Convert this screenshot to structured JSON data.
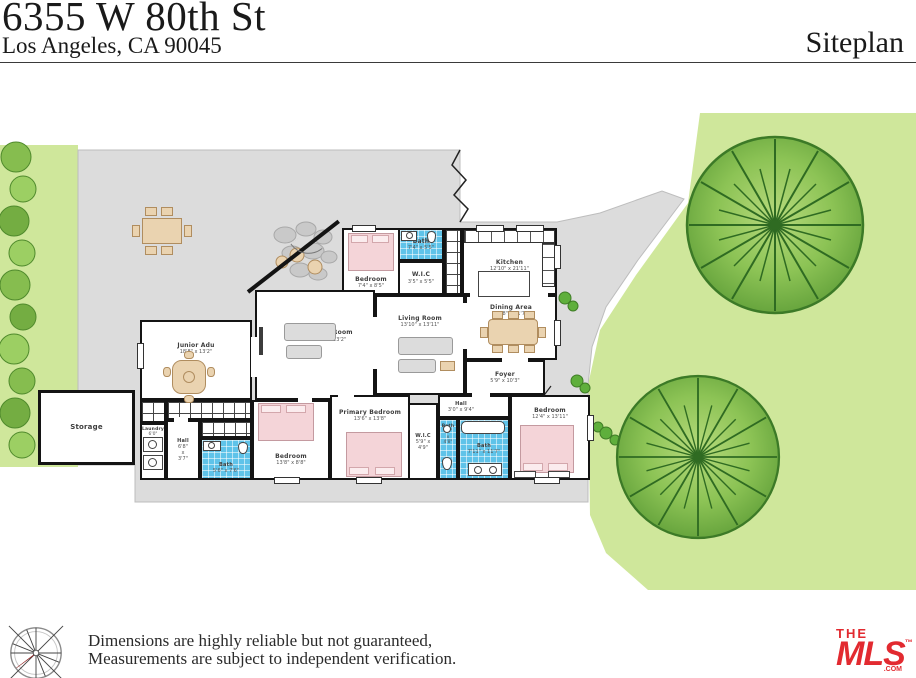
{
  "header": {
    "address_line1": "6355 W 80th St",
    "address_line2": "Los Angeles, CA 90045",
    "sheet_label": "Siteplan"
  },
  "rooms": {
    "bedroom_top": {
      "label": "Bedroom",
      "dims": "7'4\" x 8'5\""
    },
    "bath_top": {
      "label": "Bath",
      "dims": "7'4\" x 5'5\""
    },
    "wic_top": {
      "label": "W.I.C",
      "dims": "3'5\" x 5'5\""
    },
    "kitchen": {
      "label": "Kitchen",
      "dims": "12'10\" x 21'11\""
    },
    "living_room": {
      "label": "Living Room",
      "dims": "13'10\" x 13'11\""
    },
    "dining_area": {
      "label": "Dining Area",
      "dims": "12'8\" x 11'7\""
    },
    "family_room": {
      "label": "Family Room",
      "dims": "18'9\" x 23'2\""
    },
    "junior_adu": {
      "label": "Junior Adu",
      "dims": "18'8\" x 13'2\""
    },
    "foyer": {
      "label": "Foyer",
      "dims": "5'9\" x 10'3\""
    },
    "hall_right": {
      "label": "Hall",
      "dims": "3'0\" x 9'4\""
    },
    "primary_bedroom": {
      "label": "Primary Bedroom",
      "dims": "13'6\" x 13'8\""
    },
    "wic_primary": {
      "label": "W.I.C",
      "dims": "5'9\" x 4'9\""
    },
    "bath_small": {
      "label": "Bath",
      "dims": "4'9\" x 4'8\""
    },
    "bath_big": {
      "label": "Bath",
      "dims": "7'11\" x 11'7\""
    },
    "bedroom_right": {
      "label": "Bedroom",
      "dims": "12'4\" x 13'11\""
    },
    "bedroom_bottom": {
      "label": "Bedroom",
      "dims": "13'8\" x 8'8\""
    },
    "bath_bottom": {
      "label": "Bath",
      "dims": "5'6\" x 7'6\""
    },
    "laundry": {
      "label": "Laundry",
      "dims": "6'0\""
    },
    "hall_left": {
      "label": "Hall",
      "dims": "6'8\" x 3'7\""
    },
    "storage": {
      "label": "Storage",
      "dims": ""
    }
  },
  "footer": {
    "disclaimer_line1": "Dimensions are highly reliable but not guaranteed,",
    "disclaimer_line2": "Measurements are subject to independent verification.",
    "logo": {
      "the": "THE",
      "mls": "MLS",
      "tm": "™",
      "com": ".COM"
    }
  },
  "colors": {
    "logo_red": "#e22a30",
    "bath_blue": "#5fc3e9",
    "lawn_green": "#cfe79b",
    "tree_green": "#5f9e38",
    "hardscape_gray": "#dcdcdc",
    "wall_black": "#141414",
    "bed_pink": "#f4d4d8",
    "furniture_tan": "#ead3b0"
  }
}
